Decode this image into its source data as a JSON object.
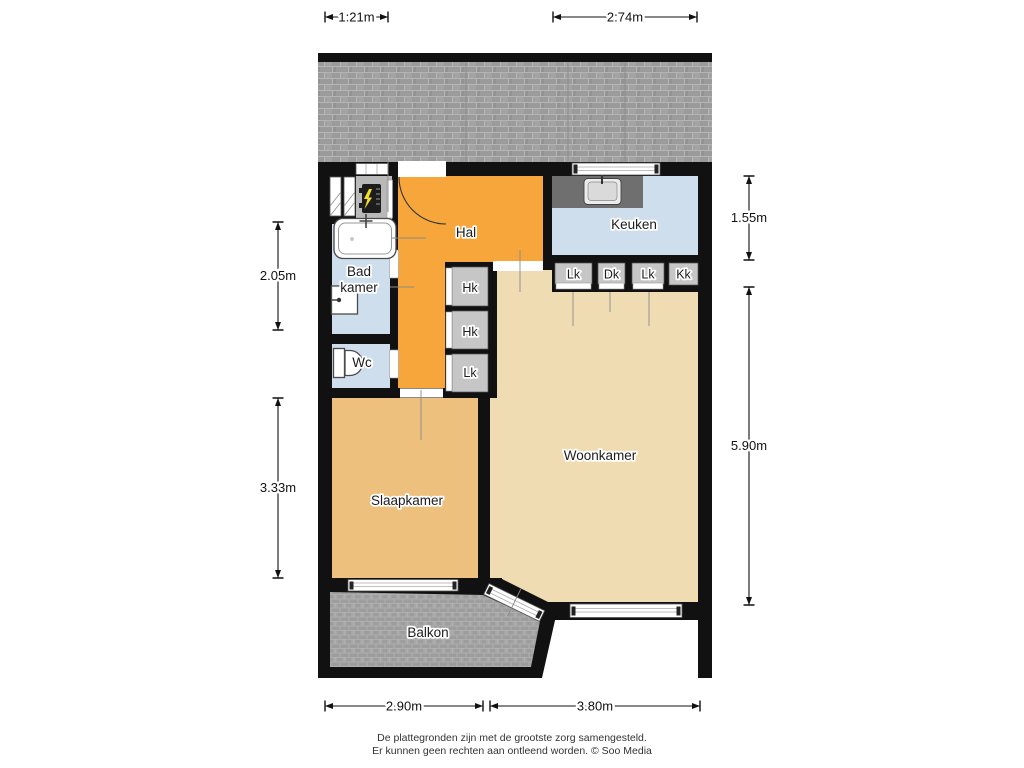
{
  "rooms": {
    "hal": "Hal",
    "keuken": "Keuken",
    "badkamer": {
      "line1": "Bad",
      "line2": "kamer"
    },
    "wc": "Wc",
    "slaapkamer": "Slaapkamer",
    "woonkamer": "Woonkamer",
    "balkon": "Balkon"
  },
  "closets": {
    "hal_top": "Hk",
    "hal_middle": "Hk",
    "hal_bottom": "Lk",
    "kitchen_1": "Lk",
    "kitchen_2": "Dk",
    "kitchen_3": "Lk",
    "kitchen_4": "Kk"
  },
  "dimensions": {
    "top_left": "1:21m",
    "top_right": "2:74m",
    "right_top": "1.55m",
    "right_bottom": "5.90m",
    "left_top": "2.05m",
    "left_bottom": "3.33m",
    "bottom_left": "2.90m",
    "bottom_right": "3.80m"
  },
  "footer": {
    "line1": "De plattegronden zijn met de grootste zorg samengesteld.",
    "line2": "Er kunnen geen rechten aan ontleend worden. © Soo Media"
  },
  "colors": {
    "hal": "#f6a63a",
    "wet_rooms": "#cfdeed",
    "slaapkamer": "#edc07d",
    "woonkamer": "#f0dcb3",
    "walls": "#111111",
    "tiles": "#9b9b9b",
    "closet": "#c6c6c6",
    "counter": "#6f6f6f",
    "boiler_accent": "#f5e027"
  }
}
